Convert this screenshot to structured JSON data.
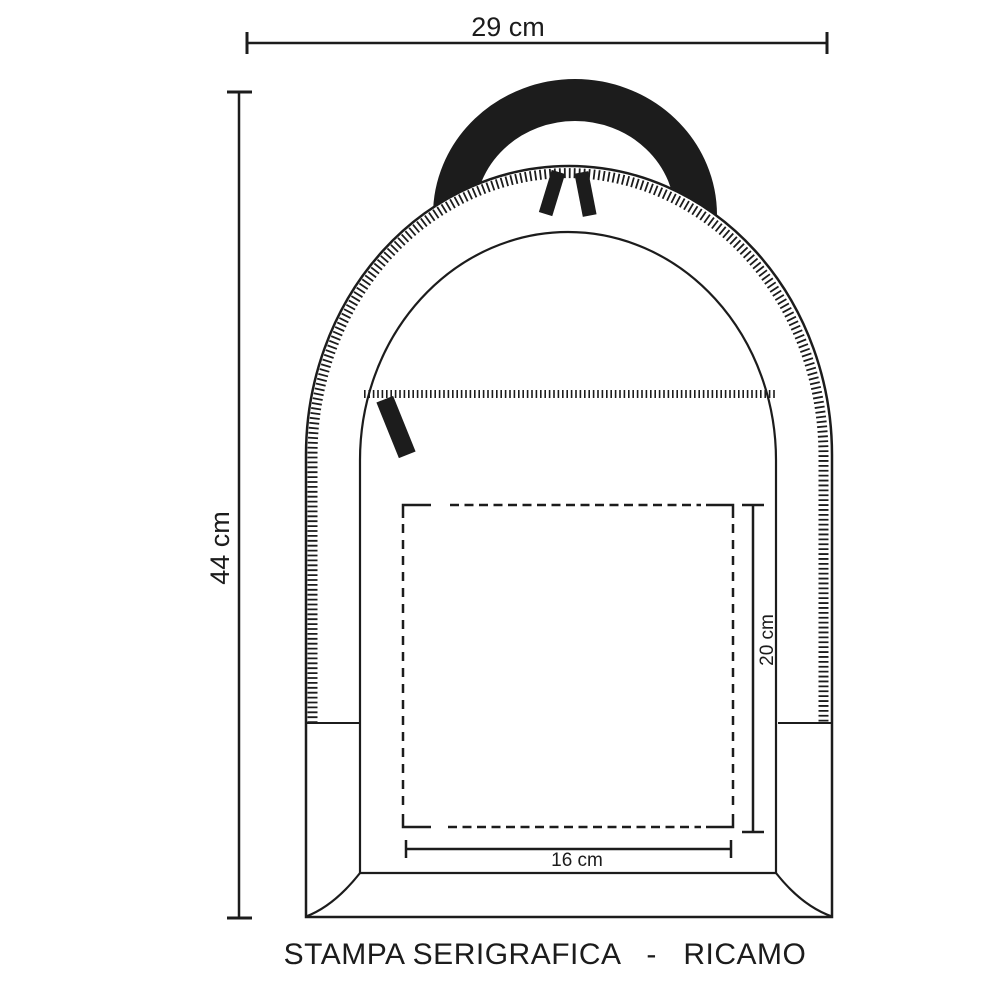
{
  "page": {
    "background": "#ffffff"
  },
  "diagram": {
    "subject": "backpack-front-view-technical-drawing",
    "caption": "STAMPA SERIGRAFICA   -   RICAMO",
    "colors": {
      "ink": "#1c1c1c",
      "paper": "#ffffff"
    },
    "dimensions": {
      "bag_width": "29 cm",
      "bag_height": "44 cm",
      "print_area_width": "16 cm",
      "print_area_height": "20 cm"
    }
  }
}
